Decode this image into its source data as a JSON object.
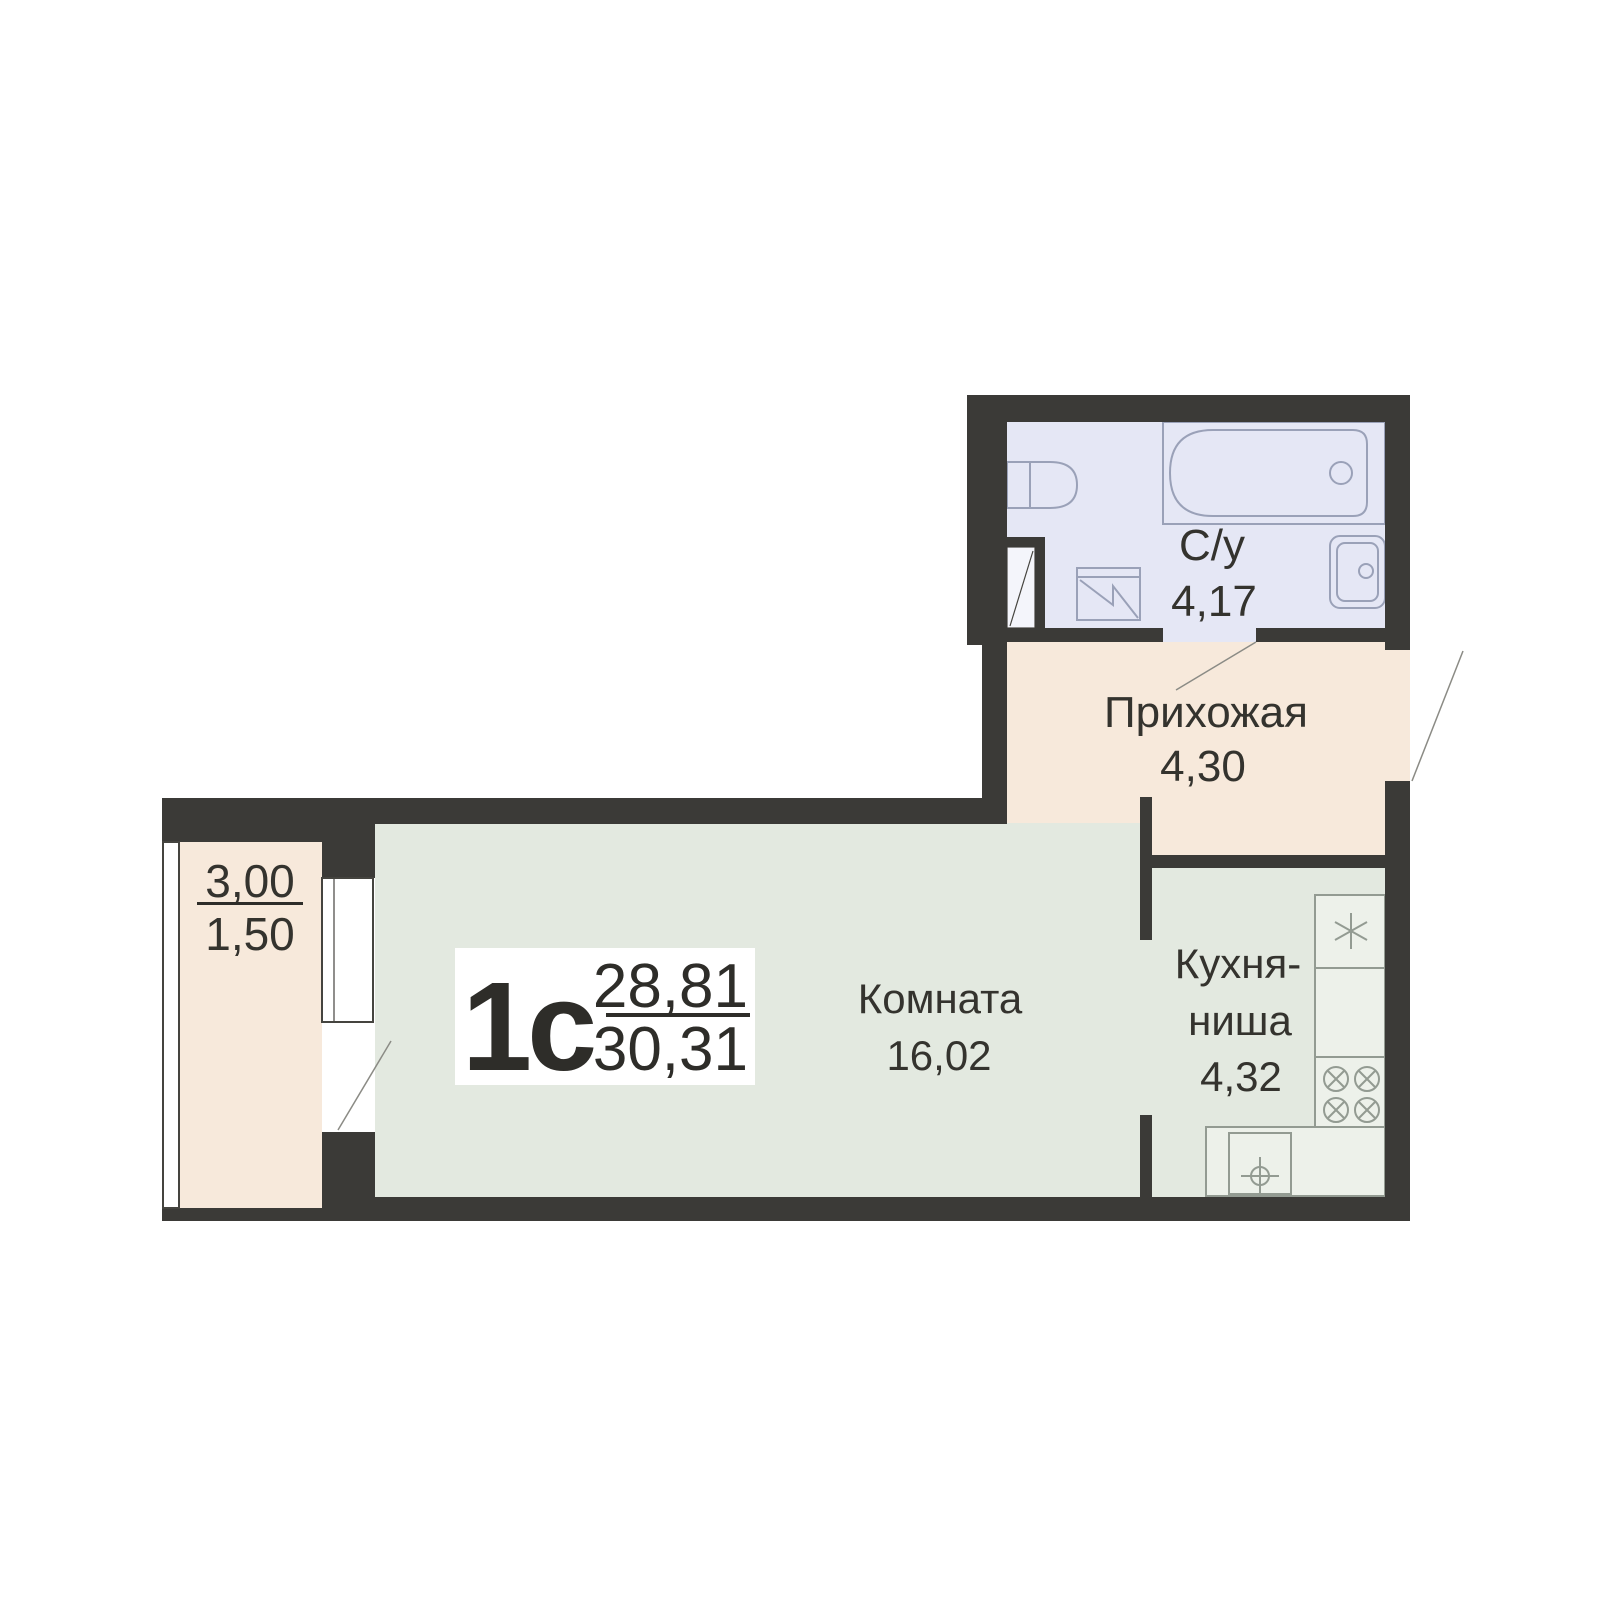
{
  "plan": {
    "unit": {
      "type": "1с",
      "area_living": "28,81",
      "area_total": "30,31"
    },
    "rooms": {
      "bathroom": {
        "label": "С/у",
        "area": "4,17"
      },
      "hallway": {
        "label": "Прихожая",
        "area": "4,30"
      },
      "living": {
        "label": "Комната",
        "area": "16,02"
      },
      "kitchen": {
        "label_line1": "Кухня-",
        "label_line2": "ниша",
        "area": "4,32"
      },
      "balcony": {
        "area_full": "3,00",
        "area_reduced": "1,50"
      }
    },
    "fixtures": [
      "bathtub",
      "toilet",
      "bathroom-sink",
      "washing-machine",
      "vent-shaft",
      "fridge",
      "stove",
      "kitchen-sink"
    ],
    "colors": {
      "wall": "#3b3a37",
      "bathroom_floor": "#e5e7f5",
      "hallway_floor": "#f7e9db",
      "room_floor": "#e3e9e0",
      "balcony_floor": "#f7e9db",
      "label_text": "#34332e"
    }
  }
}
